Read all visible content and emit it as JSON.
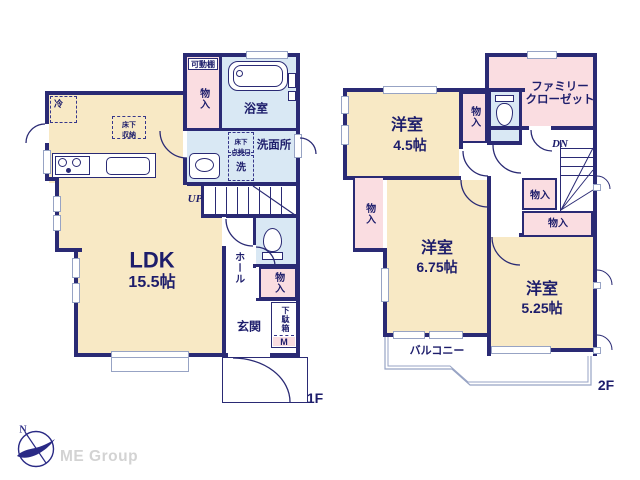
{
  "floor1": {
    "floor_label": "1F",
    "ldk": {
      "name": "LDK",
      "size": "15.5帖"
    },
    "bath": "浴室",
    "washroom": "洗面所",
    "laundry": "洗",
    "inspection_hatch": {
      "line1": "床下",
      "line2": "点検口"
    },
    "underfloor_storage": {
      "line1": "床下",
      "line2": "収納"
    },
    "fridge": "冷",
    "movable_shelf": "可動棚",
    "closet_top": "物入",
    "hall": "ホール",
    "closet_hall": "物入",
    "entrance": "玄関",
    "shoe_box": "下駄箱",
    "meter": "M",
    "stairs": "UP"
  },
  "floor2": {
    "floor_label": "2F",
    "room_a": {
      "name": "洋室",
      "size": "4.5帖"
    },
    "room_b": {
      "name": "洋室",
      "size": "6.75帖"
    },
    "room_c": {
      "name": "洋室",
      "size": "5.25帖"
    },
    "family_closet": {
      "line1": "ファミリー",
      "line2": "クローゼット"
    },
    "closet_a": "物入",
    "closet_b": "物入",
    "closet_c": "物入",
    "closet_d": "物入",
    "balcony": "バルコニー",
    "stairs": "DN"
  },
  "branding": {
    "company": "ME Group",
    "compass_north": "N"
  },
  "palette": {
    "room_cream": "#f8e9c5",
    "closet_pink": "#fadde1",
    "wet_blue": "#d9e8f4",
    "wall_navy": "#2a2a74",
    "text_navy": "#1d1d6b",
    "line_gray": "#97a3c4",
    "logo_gray": "#d3d3d3",
    "logo_navy": "#2a2a85"
  }
}
